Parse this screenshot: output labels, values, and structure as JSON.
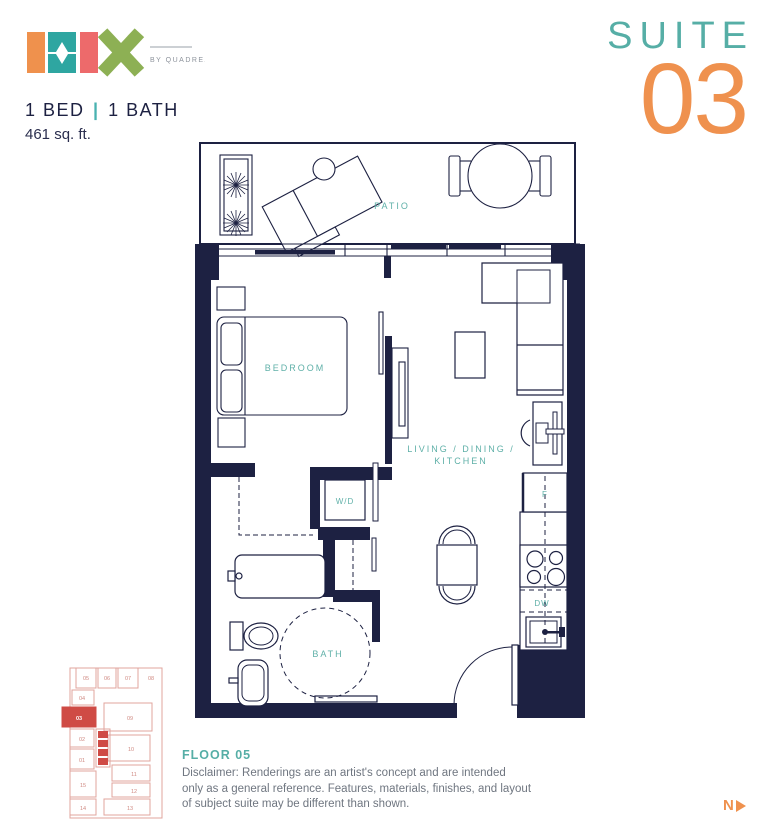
{
  "header": {
    "brand": "MIX",
    "byline": "BY QUADREAL",
    "bed_bath": {
      "beds": "1 BED",
      "sep": "|",
      "baths": "1 BATH"
    },
    "area": "461 sq. ft.",
    "suite_word": "SUITE",
    "suite_number": "03"
  },
  "plan": {
    "labels": {
      "patio": "PATIO",
      "bedroom": "BEDROOM",
      "living_line1": "LIVING / DINING /",
      "living_line2": "KITCHEN",
      "bath": "BATH",
      "washer_dryer": "W/D",
      "fridge": "F",
      "dishwasher": "DW"
    }
  },
  "keyplan": {
    "highlighted_unit": "03",
    "units": [
      "05",
      "06",
      "07",
      "08",
      "04",
      "03",
      "02",
      "01",
      "09",
      "10",
      "15",
      "11",
      "12",
      "14",
      "13"
    ]
  },
  "footer": {
    "floor_label": "FLOOR 05",
    "disclaimer": [
      "Disclaimer: Renderings are an artist's concept and are intended",
      "only as a general reference. Features, materials, finishes, and layout",
      "of subject suite may be different than shown."
    ],
    "north_label": "N"
  },
  "colors": {
    "navy": "#1d2142",
    "teal": "#5fb0a8",
    "orange": "#ef914e",
    "logo_teal": "#2ea6a1",
    "logo_pink": "#ed6a6b",
    "logo_green": "#8db054",
    "keyplan_red": "#cf4b45",
    "keyplan_light": "#e0a49e",
    "text_gray": "#6f7680"
  }
}
